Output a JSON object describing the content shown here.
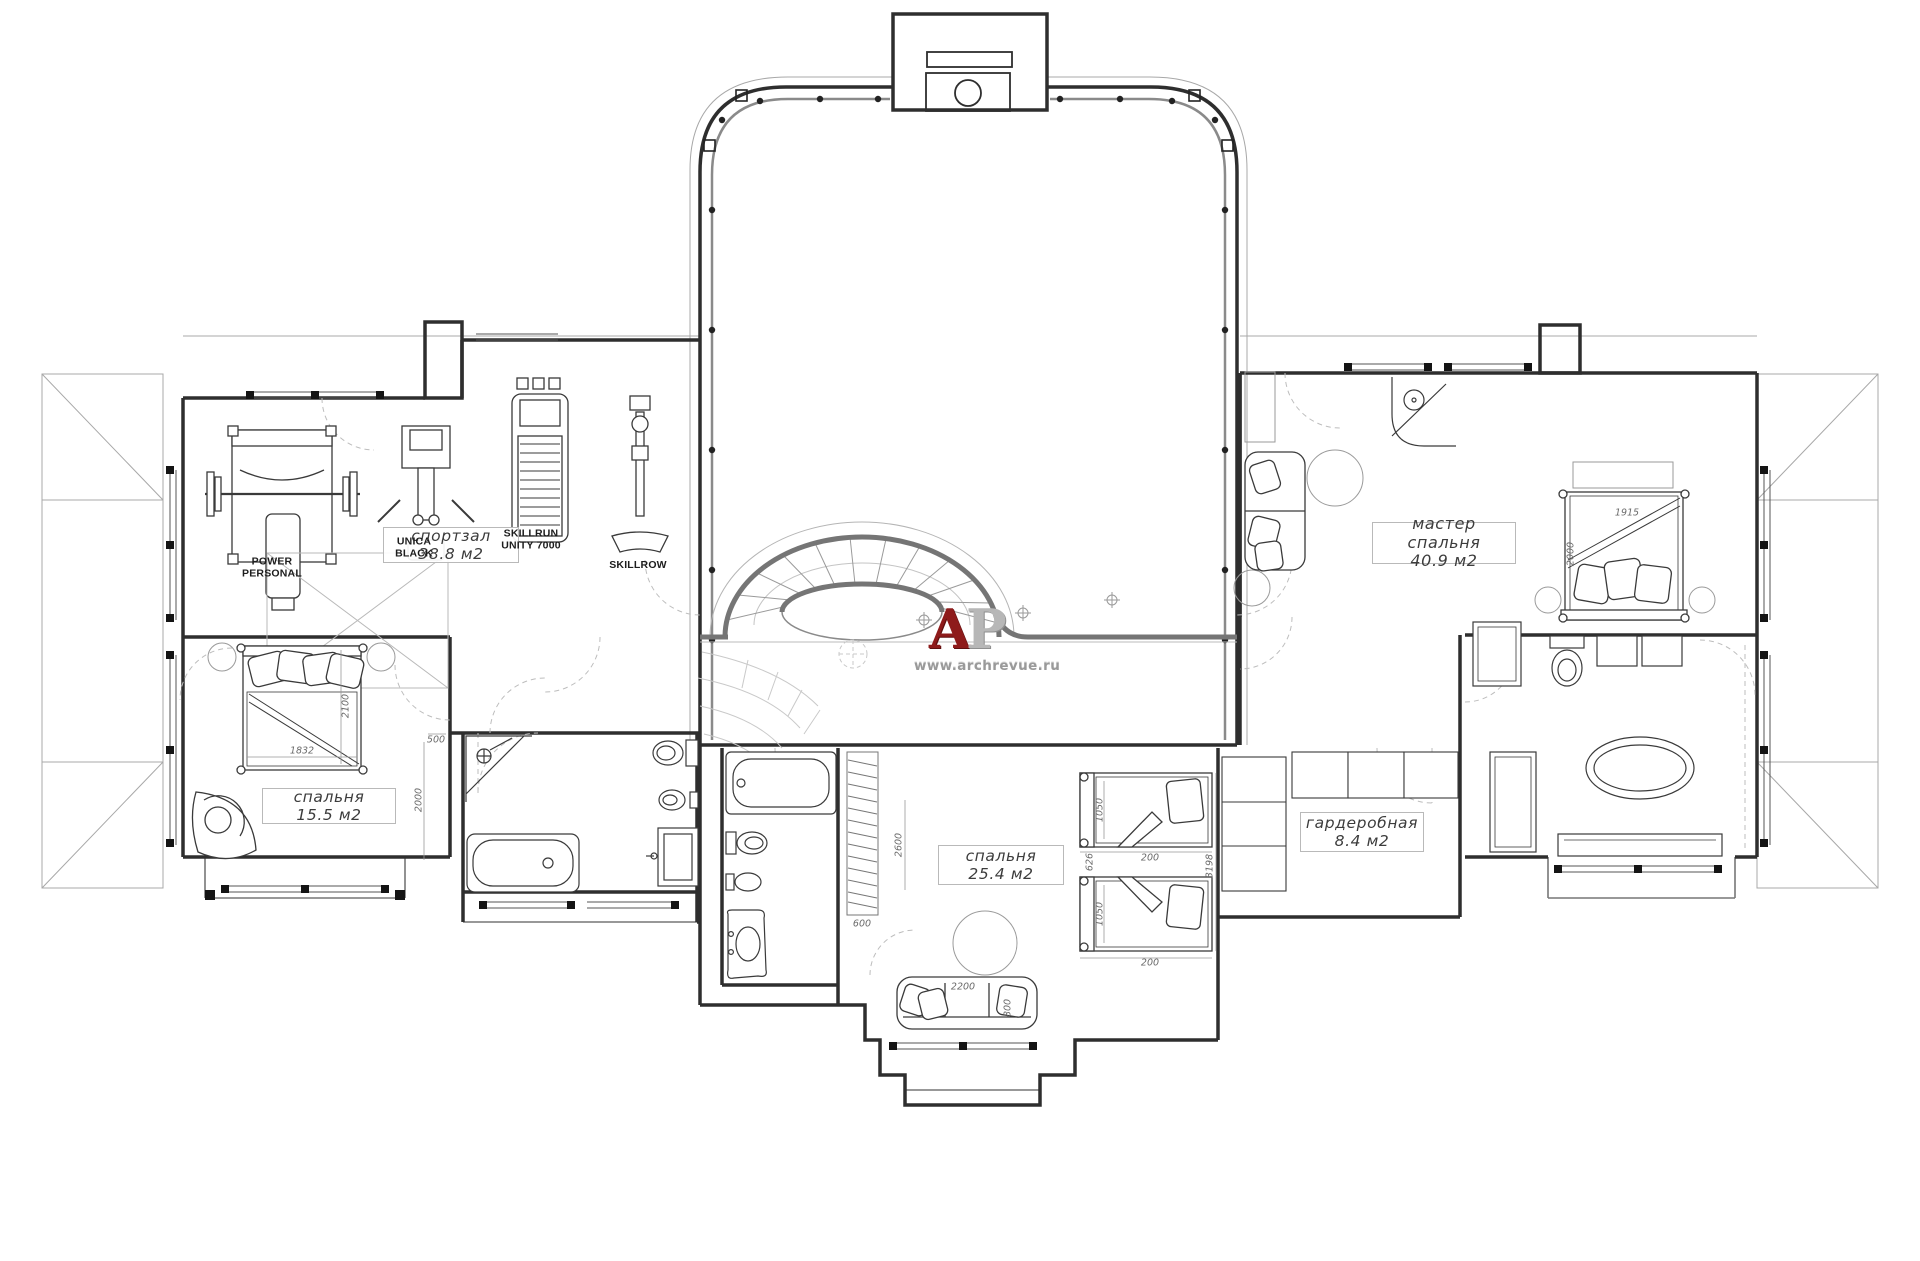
{
  "watermark": {
    "letter_a": "А",
    "letter_p": "Р",
    "url": "www.archrevue.ru",
    "color_primary": "#8e1b1b",
    "color_secondary": "#b7b7b7"
  },
  "rooms": {
    "gym": {
      "label": "спортзал",
      "area": "38.8 м2"
    },
    "master": {
      "label": "мастер спальня",
      "area": "40.9 м2"
    },
    "bedroom_small": {
      "label": "спальня",
      "area": "15.5 м2"
    },
    "bedroom_kids": {
      "label": "спальня",
      "area": "25.4 м2"
    },
    "wardrobe": {
      "label": "гардеробная",
      "area": "8.4 м2"
    }
  },
  "equipment": {
    "power_rack": "POWER PERSONAL",
    "press_machine": "UNICA BLACK",
    "treadmill": "SKILLRUN UNITY 7000",
    "rower": "SKILLROW"
  },
  "dimensions": {
    "bed15_width": "1832",
    "bed15_length": "2100",
    "bed15_offset": "500",
    "bed15_wall": "2000",
    "master_bed_width": "1915",
    "master_bed_length": "2000",
    "kids_bed1_width": "1050",
    "kids_bed2_width": "1050",
    "kids_offset1": "200",
    "kids_offset2": "200",
    "kids_gap": "626",
    "kids_total": "3198",
    "sofa_width": "2200",
    "sofa_depth": "800",
    "rail_width": "600",
    "bath_height": "2600"
  }
}
